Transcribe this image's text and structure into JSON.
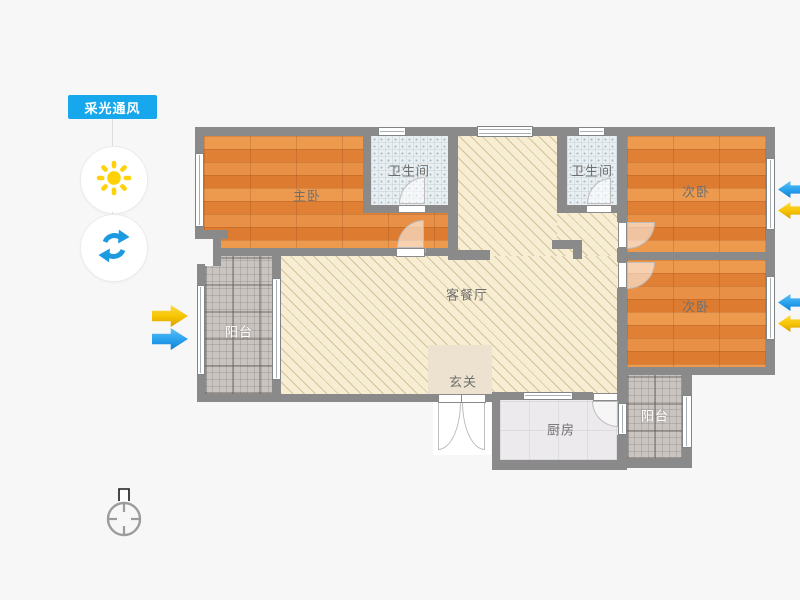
{
  "toolbar": {
    "badge_label": "采光通风"
  },
  "controls": {
    "sun_button_icon": "sun-icon",
    "rotate_button_icon": "refresh-icon",
    "compass_icon": "compass-north-icon"
  },
  "rooms": {
    "master_bedroom": {
      "label": "主卧",
      "floor": "wood"
    },
    "bathroom_1": {
      "label": "卫生间",
      "floor": "tile"
    },
    "bathroom_2": {
      "label": "卫生间",
      "floor": "tile"
    },
    "bedroom_a": {
      "label": "次卧",
      "floor": "wood"
    },
    "bedroom_b": {
      "label": "次卧",
      "floor": "wood"
    },
    "living_dining": {
      "label": "客餐厅",
      "floor": "hatch"
    },
    "foyer": {
      "label": "玄关",
      "floor": "plain"
    },
    "balcony_left": {
      "label": "阳台",
      "floor": "gray-tile"
    },
    "balcony_right": {
      "label": "阳台",
      "floor": "gray-tile"
    },
    "kitchen": {
      "label": "厨房",
      "floor": "light-tile"
    }
  },
  "arrows": [
    {
      "type": "sunlight",
      "color": "#F6C400",
      "side": "left",
      "direction": "right"
    },
    {
      "type": "ventilation",
      "color": "#2AA2EE",
      "side": "left",
      "direction": "right"
    },
    {
      "type": "ventilation",
      "color": "#2AA2EE",
      "side": "right-top",
      "direction": "left"
    },
    {
      "type": "sunlight",
      "color": "#F6C400",
      "side": "right-top",
      "direction": "left"
    },
    {
      "type": "ventilation",
      "color": "#2AA2EE",
      "side": "right-bottom",
      "direction": "left"
    },
    {
      "type": "sunlight",
      "color": "#F6C400",
      "side": "right-bottom",
      "direction": "left"
    }
  ],
  "palette": {
    "accent_blue": "#17A7EC",
    "sun_yellow": "#FFD208",
    "refresh_blue": "#1E9BE0",
    "wall_gray": "#8A8A8A",
    "wood_floor": "#E2823A",
    "living_floor": "#F7EDD3",
    "bath_tile": "#EAEFF2",
    "balcony_tile": "#C9C4C0",
    "background": "#F7F7F8"
  }
}
